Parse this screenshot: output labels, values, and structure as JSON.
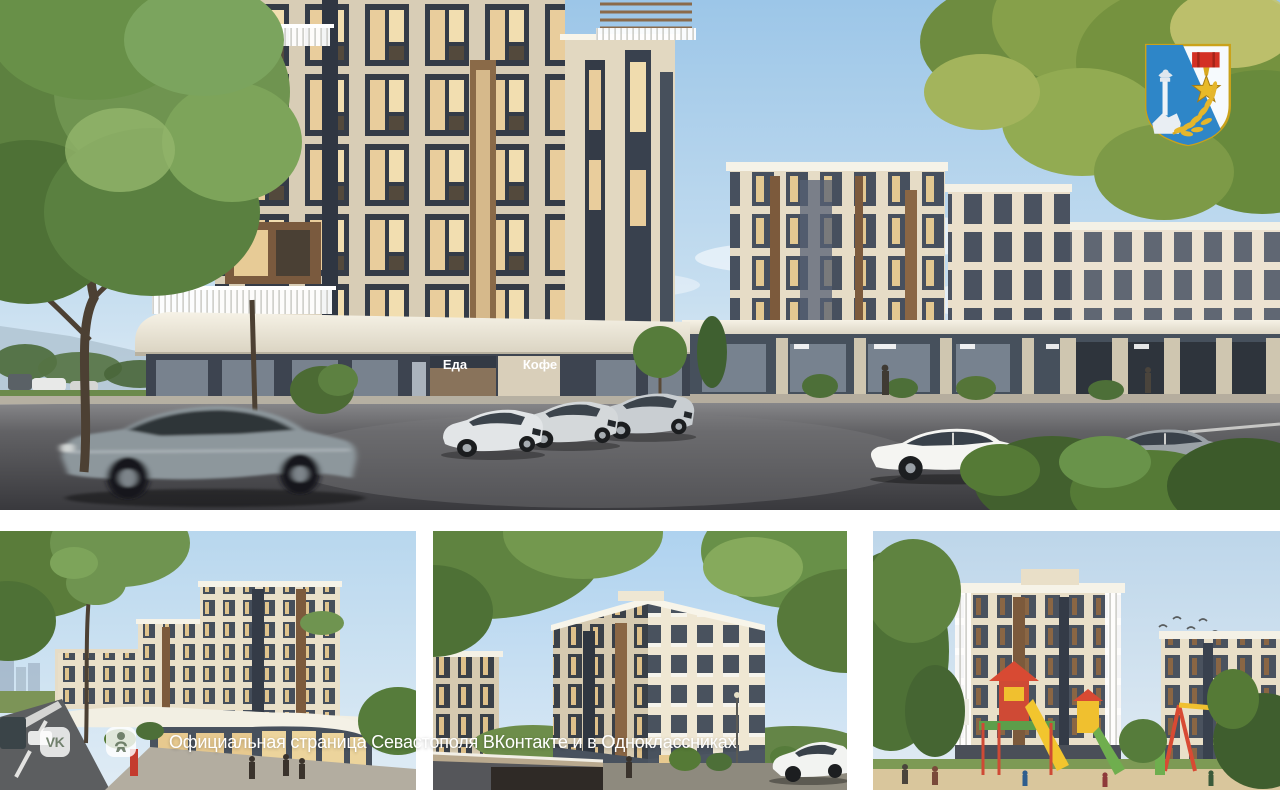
{
  "caption": {
    "vk_icon_label": "VK",
    "text": "Официальная страница Севастополя ВКонтакте и в Одноклассниках"
  },
  "main_photo": {
    "signs": {
      "food": "Еда",
      "coffee": "Кофе"
    }
  },
  "icons": {
    "vk": "vk-logo",
    "ok": "odnoklassniki-logo",
    "emblem": "sevastopol-coat-of-arms"
  },
  "colors": {
    "caption_text": "#ffffff",
    "shield_blue": "#2e86c8",
    "shield_gold": "#e3b422",
    "ribbon_red": "#d33024",
    "facade_cream": "#d8cdb6",
    "panel_dark": "#343b47",
    "lit_window": "#e9cd9c",
    "sky": "#9cc6e8"
  }
}
